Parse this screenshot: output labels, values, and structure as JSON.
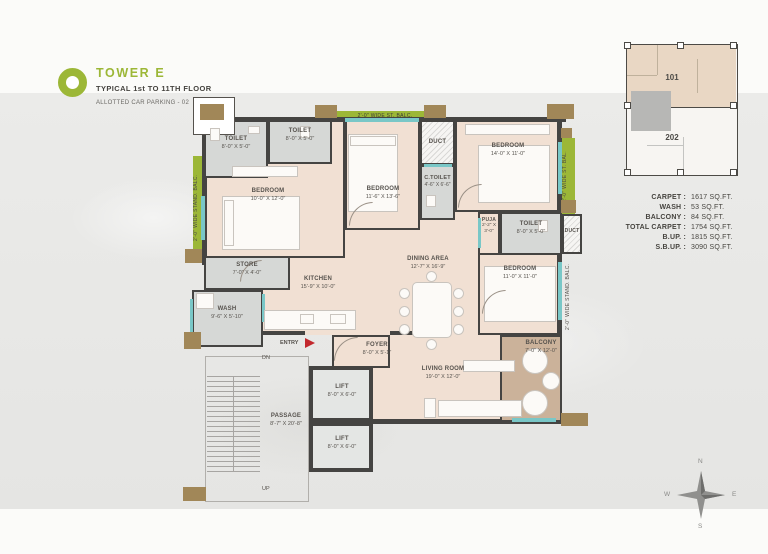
{
  "header": {
    "title": "TOWER E",
    "subtitle": "TYPICAL 1st TO 11TH FLOOR",
    "parking": "ALLOTTED CAR PARKING - 02"
  },
  "keyplan": {
    "unit_top": "101",
    "unit_bottom": "202"
  },
  "stats": {
    "rows": [
      {
        "label": "CARPET :",
        "value": "1617 SQ.FT."
      },
      {
        "label": "WASH :",
        "value": "53 SQ.FT."
      },
      {
        "label": "BALCONY :",
        "value": "84 SQ.FT."
      },
      {
        "label": "TOTAL CARPET :",
        "value": "1754 SQ.FT."
      },
      {
        "label": "B.UP. :",
        "value": "1815 SQ.FT."
      },
      {
        "label": "S.B.UP. :",
        "value": "3090 SQ.FT."
      }
    ]
  },
  "plan": {
    "rooms": {
      "toilet_a": {
        "name": "TOILET",
        "dims": "8'-0\" X 5'-0\""
      },
      "toilet_b": {
        "name": "TOILET",
        "dims": "8'-0\" X 5'-0\""
      },
      "bedroom_1": {
        "name": "BEDROOM",
        "dims": "10'-0\" X 12'-0\""
      },
      "bedroom_2": {
        "name": "BEDROOM",
        "dims": "11'-6\" X 13'-6\""
      },
      "duct_top": {
        "name": "DUCT"
      },
      "c_toilet": {
        "name": "C.TOILET",
        "dims": "4'-6\" X 6'-6\""
      },
      "bedroom_3": {
        "name": "BEDROOM",
        "dims": "14'-0\" X 11'-0\""
      },
      "puja": {
        "name": "PUJA",
        "dims": "2'-2\" X 3'-0\""
      },
      "toilet_c": {
        "name": "TOILET",
        "dims": "8'-0\" X 5'-0\""
      },
      "duct_right": {
        "name": "DUCT"
      },
      "store": {
        "name": "STORE",
        "dims": "7'-0\" X 4'-0\""
      },
      "wash": {
        "name": "WASH",
        "dims": "9'-6\" X 5'-10\""
      },
      "kitchen": {
        "name": "KITCHEN",
        "dims": "15'-9\" X 10'-0\""
      },
      "dining": {
        "name": "DINING AREA",
        "dims": "12'-7\" X 16'-9\""
      },
      "bedroom_4": {
        "name": "BEDROOM",
        "dims": "11'-0\" X 11'-0\""
      },
      "balcony": {
        "name": "BALCONY",
        "dims": "7'-0\" X 12'-0\""
      },
      "foyer": {
        "name": "FOYER",
        "dims": "8'-0\" X 5'-1\""
      },
      "living": {
        "name": "LIVING ROOM",
        "dims": "19'-0\" X 12'-0\""
      },
      "lift_a": {
        "name": "LIFT",
        "dims": "8'-0\" X 6'-0\""
      },
      "lift_b": {
        "name": "LIFT",
        "dims": "8'-0\" X 6'-0\""
      },
      "passage": {
        "name": "PASSAGE",
        "dims": "8'-7\" X 20'-8\""
      }
    },
    "strips": {
      "left": "2'-0\" WIDE STAND. BALC.",
      "top": "2'-0\" WIDE ST. BALC.",
      "right_top": "2'-0\" WIDE ST. BAL.",
      "right_bottom": "2'-0\" WIDE STAND. BALC."
    },
    "markers": {
      "entry": "ENTRY",
      "dn": "DN",
      "up": "UP"
    }
  },
  "compass": {
    "n": "N",
    "e": "E",
    "s": "S",
    "w": "W"
  },
  "colors": {
    "accent_green": "#9cb737",
    "wall_dark": "#454442",
    "floor_beige": "#f1e0d3",
    "wet_gray": "#d6d8d6",
    "balcony_tan": "#cbb29a",
    "window_teal": "#79c7c7",
    "entry_red": "#c2282d",
    "column_brown": "#a18758"
  }
}
